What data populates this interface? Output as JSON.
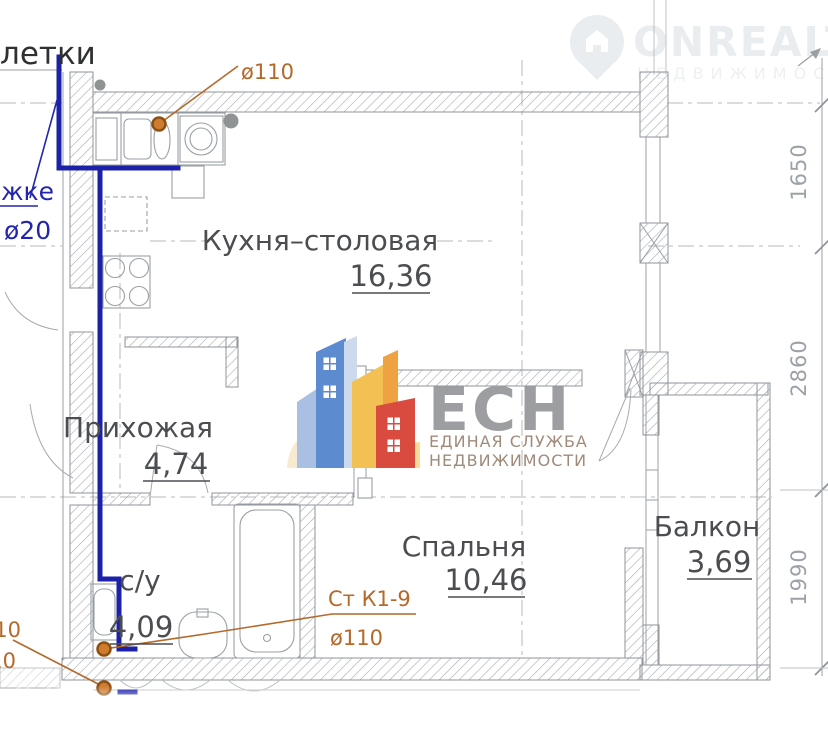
{
  "plan": {
    "rooms": [
      {
        "name": "Кухня–столовая",
        "area": "16,36"
      },
      {
        "name": "Прихожая",
        "area": "4,74"
      },
      {
        "name": "с/у",
        "area": "4,09"
      },
      {
        "name": "Спальня",
        "area": "10,46"
      },
      {
        "name": "Балкон",
        "area": "3,69"
      }
    ],
    "dimensions": {
      "d1": "1650",
      "d2": "2860",
      "d3": "1990"
    },
    "annotations": {
      "sewer_top": "ø110",
      "riser_name": "Ст К1-9",
      "sewer_bottom": "ø110",
      "left_cut_1": "ø110",
      "left_cut_2": "ø110",
      "water_note": "жке",
      "water_dia": "ø20",
      "stair_fragment": "летки"
    }
  },
  "watermarks": {
    "onrealt": {
      "brand": "ONREALT",
      "subtitle": "НЕДВИЖИМОСТЬ"
    },
    "ecn": {
      "abbr": "ЕСН",
      "line1": "ЕДИНАЯ СЛУЖБА",
      "line2": "НЕДВИЖИМОСТИ"
    }
  }
}
